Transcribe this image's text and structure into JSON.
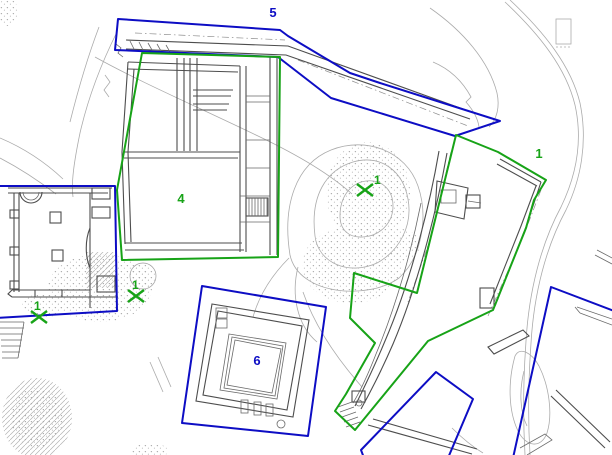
{
  "plan": {
    "colors": {
      "blue": "#0d0dc4",
      "green": "#17a317",
      "wall_gray": "#4d4d4d",
      "contour_gray": "#ababab"
    },
    "zones": [
      {
        "name": "zone-5",
        "color": "blue",
        "shape": "polygon",
        "points": "118,19 280,30 288,36 350,73 380,83 500,121 455,136 331,98 278,57 115,50",
        "label": {
          "text": "5",
          "x": 273,
          "y": 17
        }
      },
      {
        "name": "zone-4",
        "color": "green",
        "shape": "polygon",
        "points": "142,53 280,57 278,257 122,260 117,190",
        "label": {
          "text": "4",
          "x": 181,
          "y": 203
        }
      },
      {
        "name": "zone-1",
        "color": "green",
        "shape": "polygon",
        "points": "456,135 498,152 546,180 534,200 526,228 493,310 428,341 355,430 335,411 346,394 375,343 350,318 354,273 417,293",
        "label": {
          "text": "1",
          "x": 539,
          "y": 158
        }
      },
      {
        "name": "zone-6",
        "color": "blue",
        "shape": "polygon",
        "points": "202,286 326,307 308,436 182,423",
        "label": {
          "text": "6",
          "x": 257,
          "y": 365
        }
      },
      {
        "name": "zone-left-building",
        "color": "blue",
        "shape": "polygon",
        "points": "-4,186 115,186 117,311 -4,318"
      },
      {
        "name": "zone-bottom-center",
        "color": "blue",
        "shape": "polygon",
        "points": "436,372 473,399 448,458 364,458 361,450"
      },
      {
        "name": "zone-right-edge",
        "color": "blue",
        "shape": "polyline",
        "points": "614,311 551,287 513,458"
      }
    ],
    "markers": [
      {
        "name": "marker-1-center",
        "label": "1",
        "x": 365,
        "y": 190,
        "label_x": 374,
        "label_y": 184
      },
      {
        "name": "marker-1-left",
        "label": "1",
        "x": 136,
        "y": 296,
        "label_x": 132,
        "label_y": 289
      },
      {
        "name": "marker-1-far-left",
        "label": "1",
        "x": 39,
        "y": 317,
        "label_x": 34,
        "label_y": 310
      }
    ]
  }
}
